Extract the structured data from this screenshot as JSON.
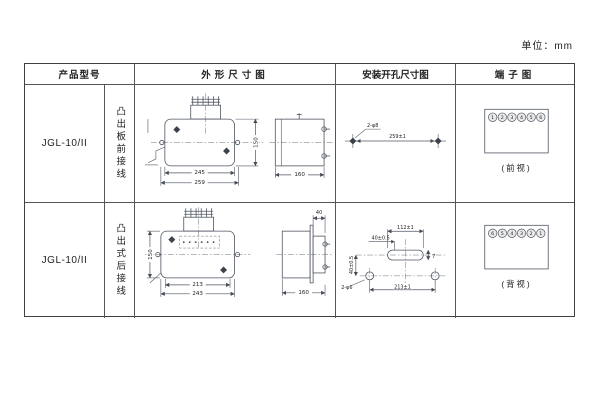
{
  "page": {
    "unit_label": "单位：mm"
  },
  "table": {
    "headers": {
      "model": "产品型号",
      "outline": "外形尺寸图",
      "install": "安装开孔尺寸图",
      "terminal": "端子图"
    }
  },
  "rows": [
    {
      "model": "JGL-10/II",
      "mounting": "凸出板前接线",
      "outline": {
        "width_inner": "245",
        "width_outer": "259",
        "height": "150",
        "depth": "160"
      },
      "install": {
        "hole_label": "2-φ8",
        "spacing": "259±1"
      },
      "terminal": {
        "numbers": [
          "1",
          "2",
          "3",
          "4",
          "5",
          "6"
        ],
        "caption": "(前视)"
      }
    },
    {
      "model": "JGL-10/II",
      "mounting": "凸出式后接线",
      "outline": {
        "width_inner": "213",
        "width_outer": "243",
        "height": "150",
        "rear_depth": "40",
        "depth": "160"
      },
      "install": {
        "slot_length": "112±1",
        "offset_left": "40±0.5",
        "offset": "40±0.5",
        "slot_height": "7",
        "hole_label": "2-φ6",
        "spacing": "213±1"
      },
      "terminal": {
        "numbers": [
          "6",
          "5",
          "4",
          "3",
          "2",
          "1"
        ],
        "caption": "(背视)"
      }
    }
  ]
}
